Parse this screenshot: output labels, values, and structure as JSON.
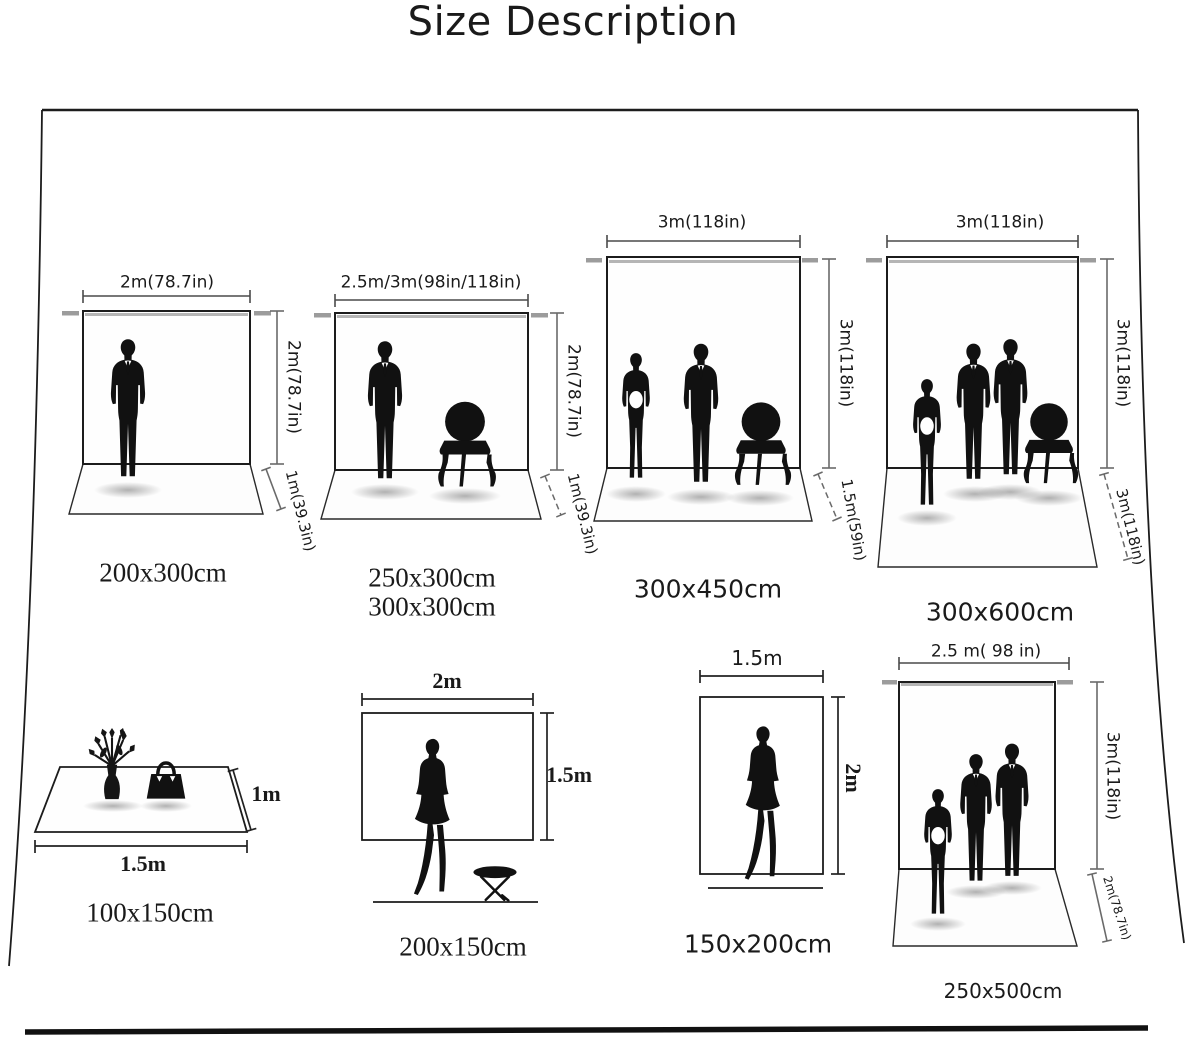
{
  "title": "Size Description",
  "colors": {
    "ink": "#1c1c1c",
    "dim_gray": "#6a6a6a",
    "rod_gray": "#9c9c9c",
    "background": "#ffffff"
  },
  "panels": [
    {
      "name": "backdrop-200x300",
      "width_label": "2m(78.7in)",
      "height_label": "2m(78.7in)",
      "floor_label": "1m(39.3in)",
      "captions": [
        "200x300cm"
      ]
    },
    {
      "name": "backdrop-250x300-300x300",
      "width_label": "2.5m/3m(98in/118in)",
      "height_label": "2m(78.7in)",
      "floor_label": "1m(39.3in)",
      "captions": [
        "250x300cm",
        "300x300cm"
      ]
    },
    {
      "name": "backdrop-300x450",
      "width_label": "3m(118in)",
      "height_label": "3m(118in)",
      "floor_label": "1.5m(59in)",
      "captions": [
        "300x450cm"
      ]
    },
    {
      "name": "backdrop-300x600",
      "width_label": "3m(118in)",
      "height_label": "3m(118in)",
      "floor_label": "3m(118in)",
      "captions": [
        "300x600cm"
      ]
    },
    {
      "name": "mat-100x150",
      "width_label": "1.5m",
      "height_label": "1m",
      "captions": [
        "100x150cm"
      ]
    },
    {
      "name": "backdrop-200x150",
      "width_label": "2m",
      "height_label": "1.5m",
      "captions": [
        "200x150cm"
      ]
    },
    {
      "name": "backdrop-150x200",
      "width_label": "1.5m",
      "height_label": "2m",
      "captions": [
        "150x200cm"
      ]
    },
    {
      "name": "backdrop-250x500",
      "width_label": "2.5 m( 98 in)",
      "height_label": "3m(118in)",
      "floor_label": "2m(78.7in)",
      "captions": [
        "250x500cm"
      ]
    }
  ]
}
